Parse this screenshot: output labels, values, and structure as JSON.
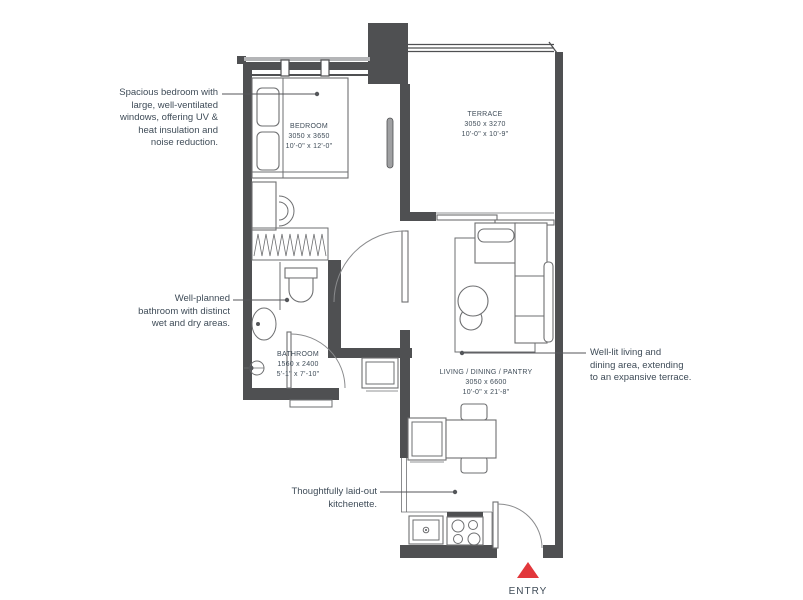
{
  "annotations": {
    "bedroom": "Spacious bedroom with\nlarge, well-ventilated\nwindows, offering UV &\nheat insulation and\nnoise reduction.",
    "bathroom": "Well-planned\nbathroom with distinct\nwet and dry areas.",
    "kitchenette": "Thoughtfully laid-out\nkitchenette.",
    "living": "Well-lit living and\ndining area, extending\nto an expansive terrace."
  },
  "rooms": {
    "bedroom": {
      "name": "BEDROOM",
      "dim_mm": "3050 x 3650",
      "dim_ft": "10'-0\" x 12'-0\""
    },
    "terrace": {
      "name": "TERRACE",
      "dim_mm": "3050 x 3270",
      "dim_ft": "10'-0\" x 10'-9\""
    },
    "bathroom": {
      "name": "BATHROOM",
      "dim_mm": "1560 x 2400",
      "dim_ft": "5'-1\" x 7'-10\""
    },
    "living": {
      "name": "LIVING / DINING / PANTRY",
      "dim_mm": "3050 x 6600",
      "dim_ft": "10'-0\" x 21'-8\""
    }
  },
  "entry": {
    "label": "ENTRY"
  },
  "colors": {
    "wall": "#4f5052",
    "line": "#6e6f71",
    "text": "#3f4c58",
    "entry_red": "#e2373b"
  }
}
